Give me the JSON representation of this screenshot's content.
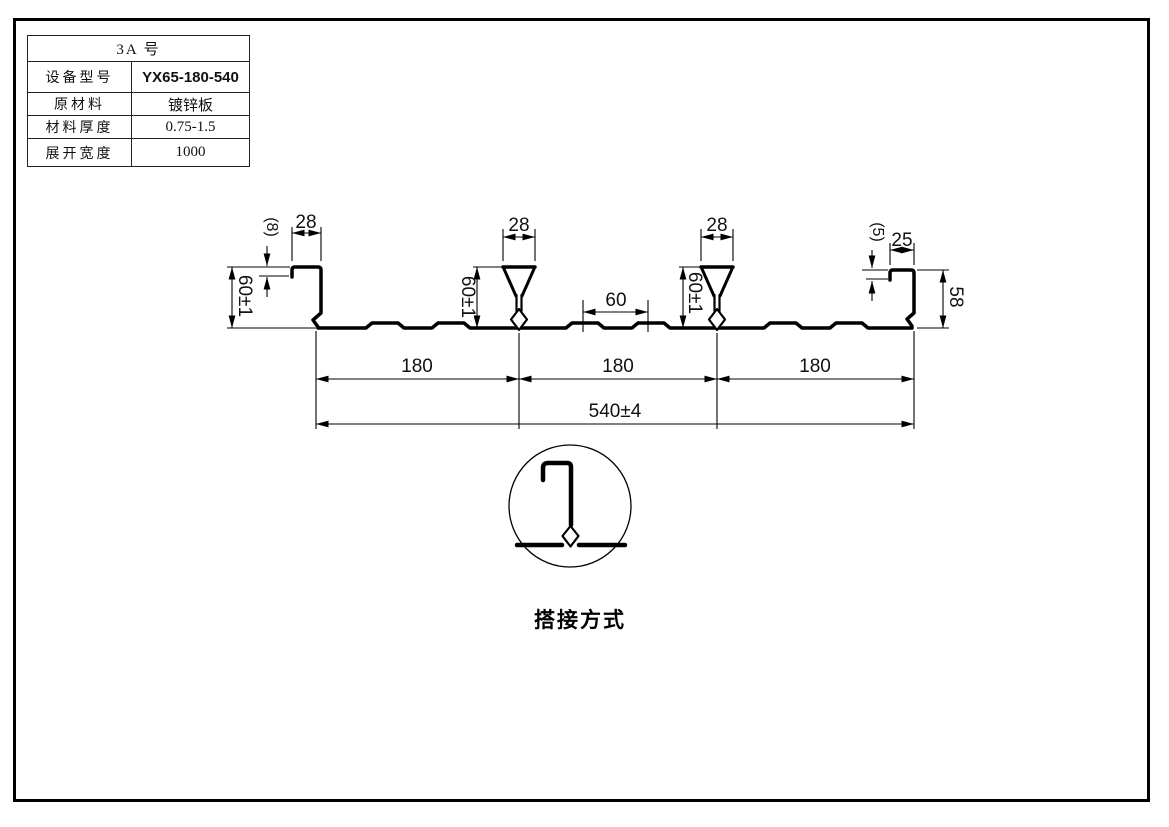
{
  "table": {
    "title": "3A  号",
    "rows": [
      {
        "label": "设备型号",
        "value": "YX65-180-540"
      },
      {
        "label": "原材料",
        "value": "镀锌板"
      },
      {
        "label": "材料厚度",
        "value": "0.75-1.5"
      },
      {
        "label": "展开宽度",
        "value": "1000"
      }
    ]
  },
  "profile": {
    "dims": {
      "left_lip": "(8)",
      "left_top": "28",
      "left_height": "60±1",
      "rib1_top": "28",
      "rib1_height": "60±1",
      "mid_span": "60",
      "rib2_top": "28",
      "rib2_height": "60±1",
      "right_lip": "(5)",
      "right_top": "25",
      "right_height": "58",
      "pitch_1": "180",
      "pitch_2": "180",
      "pitch_3": "180",
      "overall": "540±4"
    }
  },
  "detail": {
    "caption": "搭接方式"
  },
  "colors": {
    "line": "#000000",
    "bg": "#ffffff"
  }
}
